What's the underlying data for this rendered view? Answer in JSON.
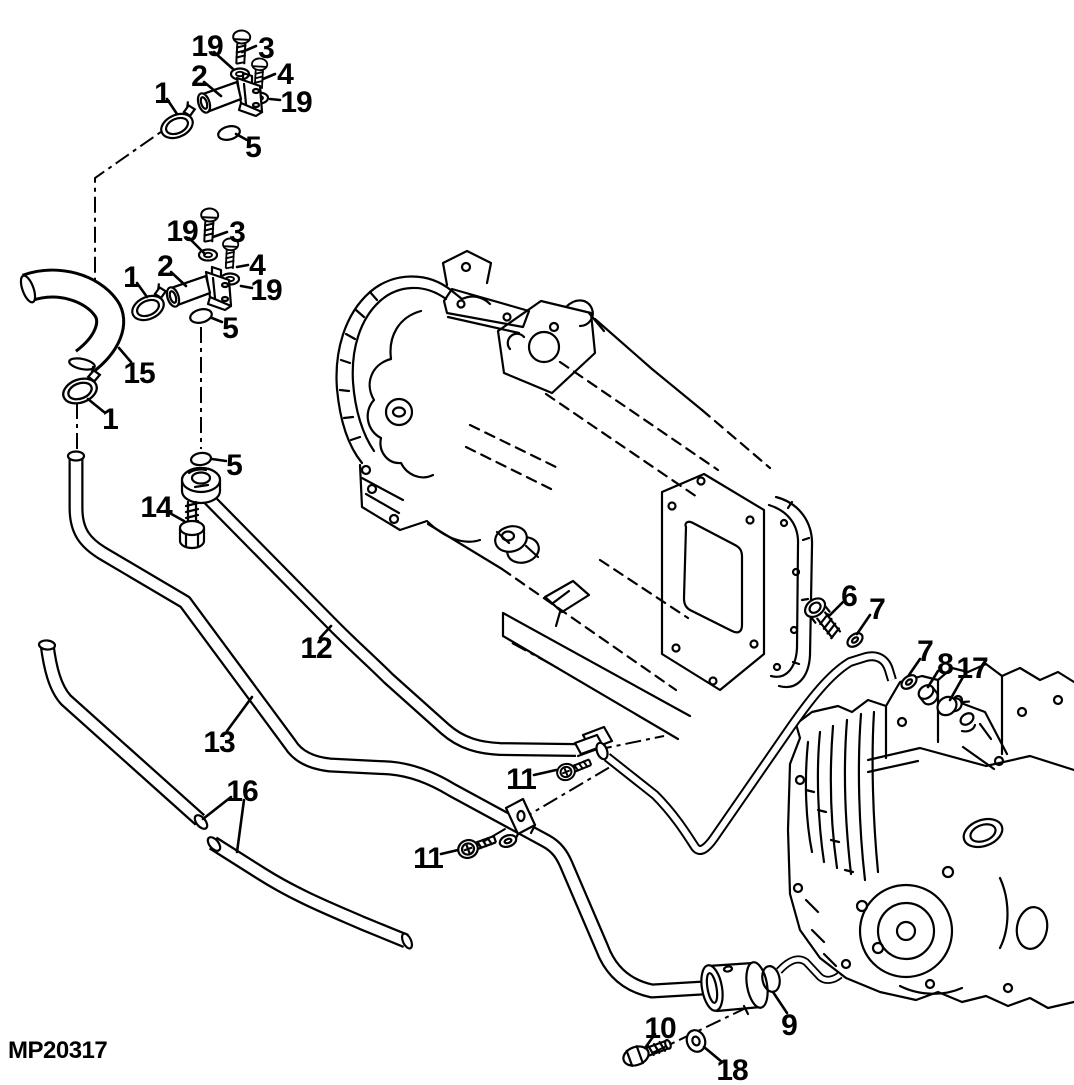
{
  "colors": {
    "background": "#ffffff",
    "line": "#000000"
  },
  "figure": {
    "part_code": "MP20317",
    "callouts": [
      {
        "label": "19"
      },
      {
        "label": "3"
      },
      {
        "label": "2"
      },
      {
        "label": "4"
      },
      {
        "label": "19"
      },
      {
        "label": "1"
      },
      {
        "label": "5"
      },
      {
        "label": "19"
      },
      {
        "label": "3"
      },
      {
        "label": "2"
      },
      {
        "label": "4"
      },
      {
        "label": "19"
      },
      {
        "label": "1"
      },
      {
        "label": "5"
      },
      {
        "label": "15"
      },
      {
        "label": "1"
      },
      {
        "label": "5"
      },
      {
        "label": "14"
      },
      {
        "label": "12"
      },
      {
        "label": "13"
      },
      {
        "label": "16"
      },
      {
        "label": "6"
      },
      {
        "label": "7"
      },
      {
        "label": "7"
      },
      {
        "label": "8"
      },
      {
        "label": "17"
      },
      {
        "label": "11"
      },
      {
        "label": "11"
      },
      {
        "label": "10"
      },
      {
        "label": "18"
      },
      {
        "label": "9"
      }
    ]
  }
}
